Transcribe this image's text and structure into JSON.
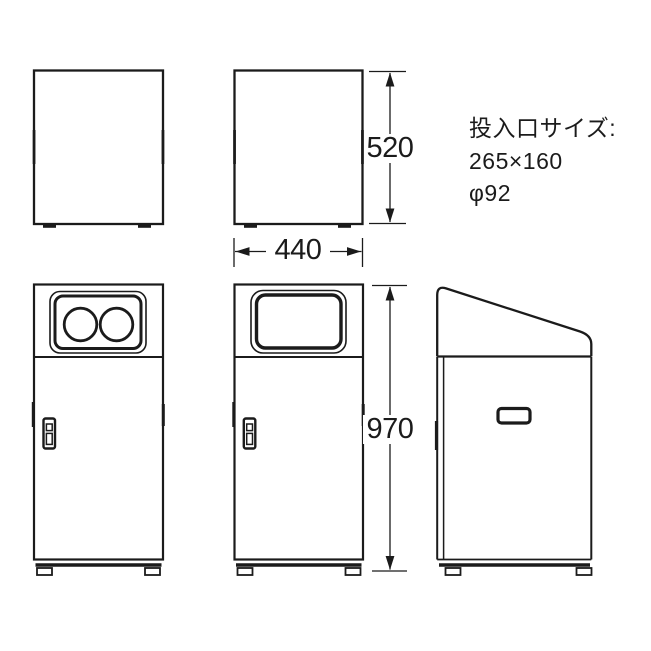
{
  "colors": {
    "background": "#ffffff",
    "line": "#1b1b1b"
  },
  "dimensions": {
    "upper_height": "520",
    "width": "440",
    "total_height": "970"
  },
  "note": {
    "title": "投入口サイズ:",
    "rectangular_opening": "265×160",
    "round_opening": "φ92"
  }
}
